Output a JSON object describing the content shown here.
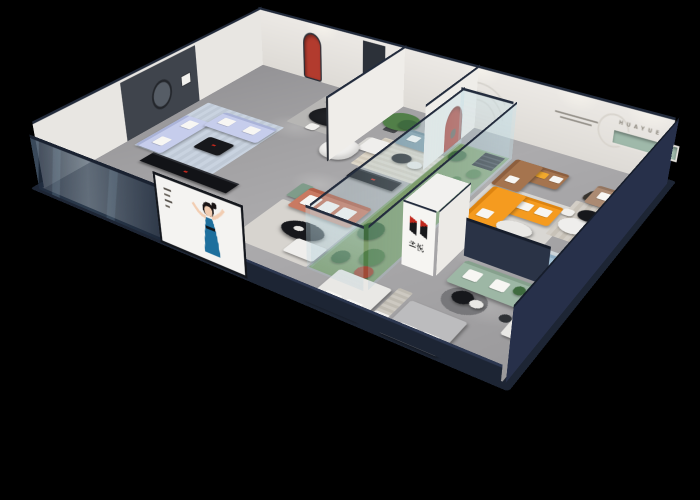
{
  "meta": {
    "type": "3d-rendered-floorplan",
    "description": "Isometric cutaway dollhouse render of a furniture showroom on a black background"
  },
  "brand": {
    "wall_letters": "HUAYUE",
    "logo_chars": "华悦",
    "logo_red": "#c0271c",
    "logo_dark": "#17181b"
  },
  "palette": {
    "background": "#000000",
    "exterior_wall": "#1d2534",
    "interior_wall": "#ebe9e5",
    "partition_navy": "#2a3346",
    "right_wall_navy": "#27304a",
    "floor": "#a2a1a3",
    "feature_panel": "#3f444c",
    "arch_red": "#b23b2e",
    "arch_red_2": "#a93328",
    "shelf_green": "#9fb9aa",
    "atrium_floor": "#7d9c6b",
    "plant_green": "#3f6b3f",
    "plant_green_2": "#517f48",
    "stair_dark": "#23262c"
  },
  "furniture": {
    "periwinkle_sofa": "#c6cdec",
    "teal_sofa": "#74919f",
    "brown_corner_sofa": "#a5744e",
    "orange_sofa": "#f59b1f",
    "taupe_sofa": "#ab8a72",
    "salmon_sofa": "#c97a62",
    "light_blue_sofa": "#a3c1d6",
    "sage_sofa": "#9db7a5",
    "white_seat": "#efeeec",
    "black_table": "#17181c",
    "dining_table_black": "#1c1e22",
    "console_black": "#121317",
    "bed_white": "#e9e8e5",
    "bed_gray": "#bcbcbe",
    "yellow_pillow": "#f0a82d",
    "orange_pillow": "#e2873f",
    "blue_ottoman": "#8fa9bd",
    "green_cabinet": "#7f9c8a",
    "bear_sculpture": "#a04a36",
    "runner_sculpture": "#38342f"
  },
  "poster": {
    "subject": "dancing woman illustration",
    "dress_color": "#1e6f9d",
    "background": "#f4f3f1"
  }
}
